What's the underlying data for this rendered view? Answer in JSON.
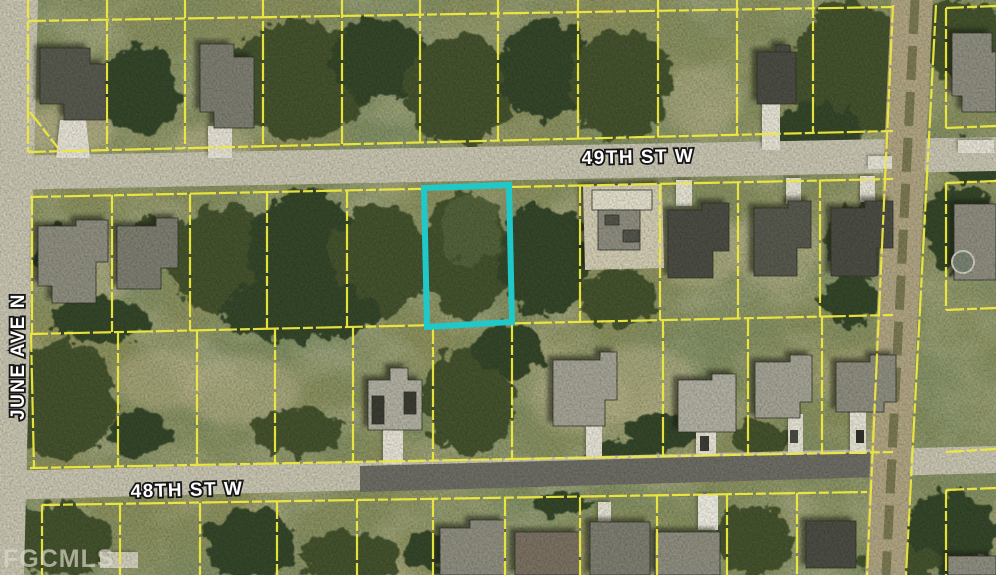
{
  "map": {
    "street_labels": [
      {
        "id": "49th-st-w",
        "text": "49TH ST W"
      },
      {
        "id": "48th-st-w",
        "text": "48TH ST W"
      },
      {
        "id": "june-ave-n",
        "text": "JUNE AVE N"
      }
    ],
    "watermark_text": "FGCMLS",
    "highlighted_parcel": {
      "description": "subject-lot-outline",
      "outline_color": "#1fc9c9"
    },
    "colors": {
      "parcel-line": "#efe93e",
      "highlight": "#1fc9c9",
      "veg-base": "#8f925e",
      "veg-dark1": "#45532f",
      "veg-dark2": "#36462a",
      "veg-dark3": "#52633a",
      "veg-light": "#b9b48c",
      "road": "#c9c6b2",
      "asphalt": "#6e6e66",
      "dirt": "#b1a684",
      "dirt-track": "#6f7048",
      "concrete": "#e7e4d6",
      "sand": "#d3cdb4",
      "roof-dark": "#4c4d44",
      "roof-dark2": "#585a4f",
      "roof-mid": "#8f8e80",
      "roof-mid2": "#7e7f71",
      "roof-light": "#b2b1a3",
      "roof-light2": "#a5a496",
      "roof-brown": "#7c7263",
      "label-fill": "#ffffff",
      "label-stroke": "#161616",
      "watermark": "#ded9cc"
    }
  }
}
